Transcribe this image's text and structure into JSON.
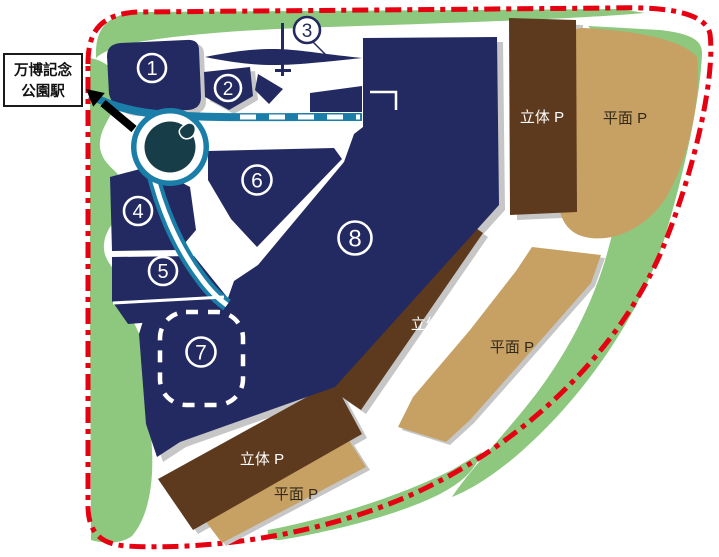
{
  "map": {
    "title": "万博記念公園 駐車場マップ",
    "station": {
      "line1": "万博記念",
      "line2": "公園駅"
    },
    "zones": [
      {
        "number": "1"
      },
      {
        "number": "2"
      },
      {
        "number": "3"
      },
      {
        "number": "4"
      },
      {
        "number": "5"
      },
      {
        "number": "6"
      },
      {
        "number": "7"
      },
      {
        "number": "8"
      }
    ],
    "parking_labels": {
      "multistory": "立体 P",
      "surface": "平面 P"
    },
    "parking_lots": [
      {
        "type": "multistory",
        "label": "立体 P",
        "location": "top-right"
      },
      {
        "type": "surface",
        "label": "平面 P",
        "location": "top-right"
      },
      {
        "type": "multistory",
        "label": "立体 P",
        "location": "middle"
      },
      {
        "type": "surface",
        "label": "平面 P",
        "location": "middle"
      },
      {
        "type": "multistory",
        "label": "立体 P",
        "location": "bottom"
      },
      {
        "type": "surface",
        "label": "平面 P",
        "location": "bottom"
      }
    ],
    "colors": {
      "zone_navy": "#232a61",
      "road_teal": "#1a7ea9",
      "roundabout_dark_teal": "#173d48",
      "green_belt": "#8dc87e",
      "multistory_brown": "#5d3a1d",
      "surface_tan": "#c7a064",
      "boundary_red": "#e50012",
      "shadow_gray": "#c6c6c6"
    }
  }
}
